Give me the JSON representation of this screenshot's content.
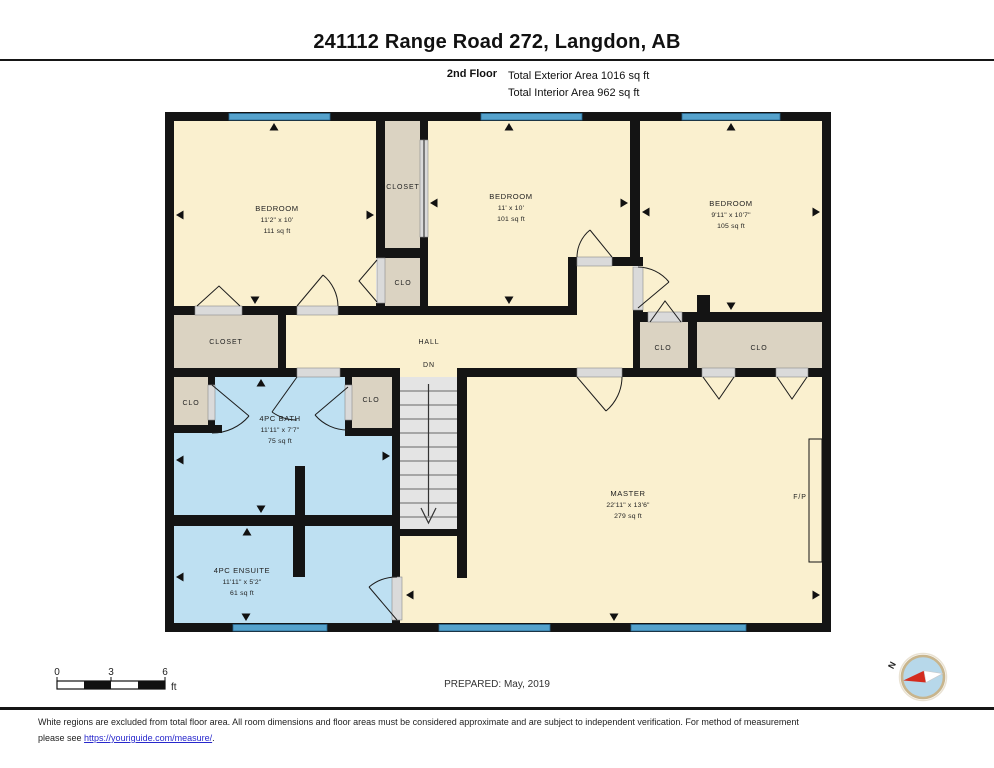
{
  "header": {
    "title": "241112 Range Road 272, Langdon, AB",
    "floor_label": "2nd Floor",
    "exterior_area": "Total Exterior Area 1016 sq ft",
    "interior_area": "Total Interior Area 962 sq ft"
  },
  "rooms": [
    {
      "id": "bedroom-1",
      "name": "BEDROOM",
      "dims": "11'2\" x 10'",
      "area": "111 sq ft"
    },
    {
      "id": "bedroom-2",
      "name": "BEDROOM",
      "dims": "11' x 10'",
      "area": "101 sq ft"
    },
    {
      "id": "bedroom-3",
      "name": "BEDROOM",
      "dims": "9'11\" x 10'7\"",
      "area": "105 sq ft"
    },
    {
      "id": "master",
      "name": "MASTER",
      "dims": "22'11\" x 13'6\"",
      "area": "279 sq ft"
    },
    {
      "id": "bath",
      "name": "4PC BATH",
      "dims": "11'11\" x 7'7\"",
      "area": "75 sq ft"
    },
    {
      "id": "ensuite",
      "name": "4PC ENSUITE",
      "dims": "11'11\" x 5'2\"",
      "area": "61 sq ft"
    }
  ],
  "labels": {
    "closet": "CLOSET",
    "clo": "CLO",
    "hall": "HALL",
    "dn": "DN",
    "fp": "F/P"
  },
  "scale_bar": {
    "ticks": [
      "0",
      "3",
      "6"
    ],
    "unit": "ft"
  },
  "prepared": "PREPARED: May, 2019",
  "compass": {
    "label": "N"
  },
  "footer": {
    "line1": "White regions are excluded from total floor area. All room dimensions and floor areas must be considered approximate and are subject to independent verification. For method of measurement",
    "line2_prefix": "please see ",
    "link": "https://youriguide.com/measure/",
    "line2_suffix": "."
  },
  "colors": {
    "room_fill": "#faf0cf",
    "closet_fill": "#dbd3c2",
    "bath_fill": "#bee0f2",
    "window_blue": "#55a2cc",
    "wall_black": "#141414",
    "stair_gray": "#e4e4e4",
    "link_blue": "#2727cc",
    "compass_ring": "#c8b58d",
    "compass_face": "#b7d8ea",
    "needle_red": "#d42b1e"
  }
}
